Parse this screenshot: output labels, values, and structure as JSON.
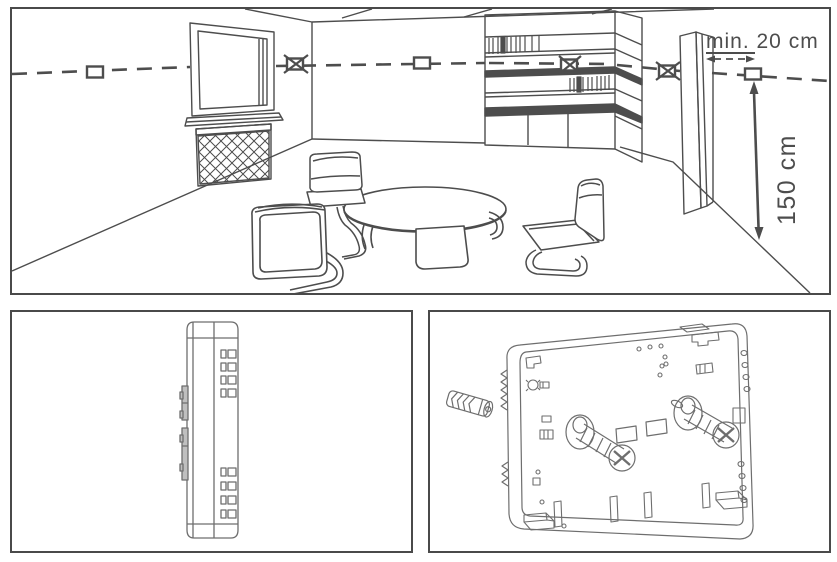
{
  "figure": {
    "panels": {
      "top": "room-placement-diagram",
      "bottom_left": "device-side-view",
      "bottom_right": "device-back-plate-mounting"
    }
  },
  "annotations": {
    "min_distance_label": "min. 20 cm",
    "mounting_height_label": "150 cm"
  },
  "markers": {
    "allowed_marker_shape": "square",
    "prohibited_marker_shape": "crossed-square",
    "allowed_count": 3,
    "prohibited_count": 3
  },
  "colors": {
    "line": "#4d4d4d",
    "device_line": "#6e6e6e",
    "panel_border": "#4a4a4a",
    "background": "#ffffff"
  }
}
